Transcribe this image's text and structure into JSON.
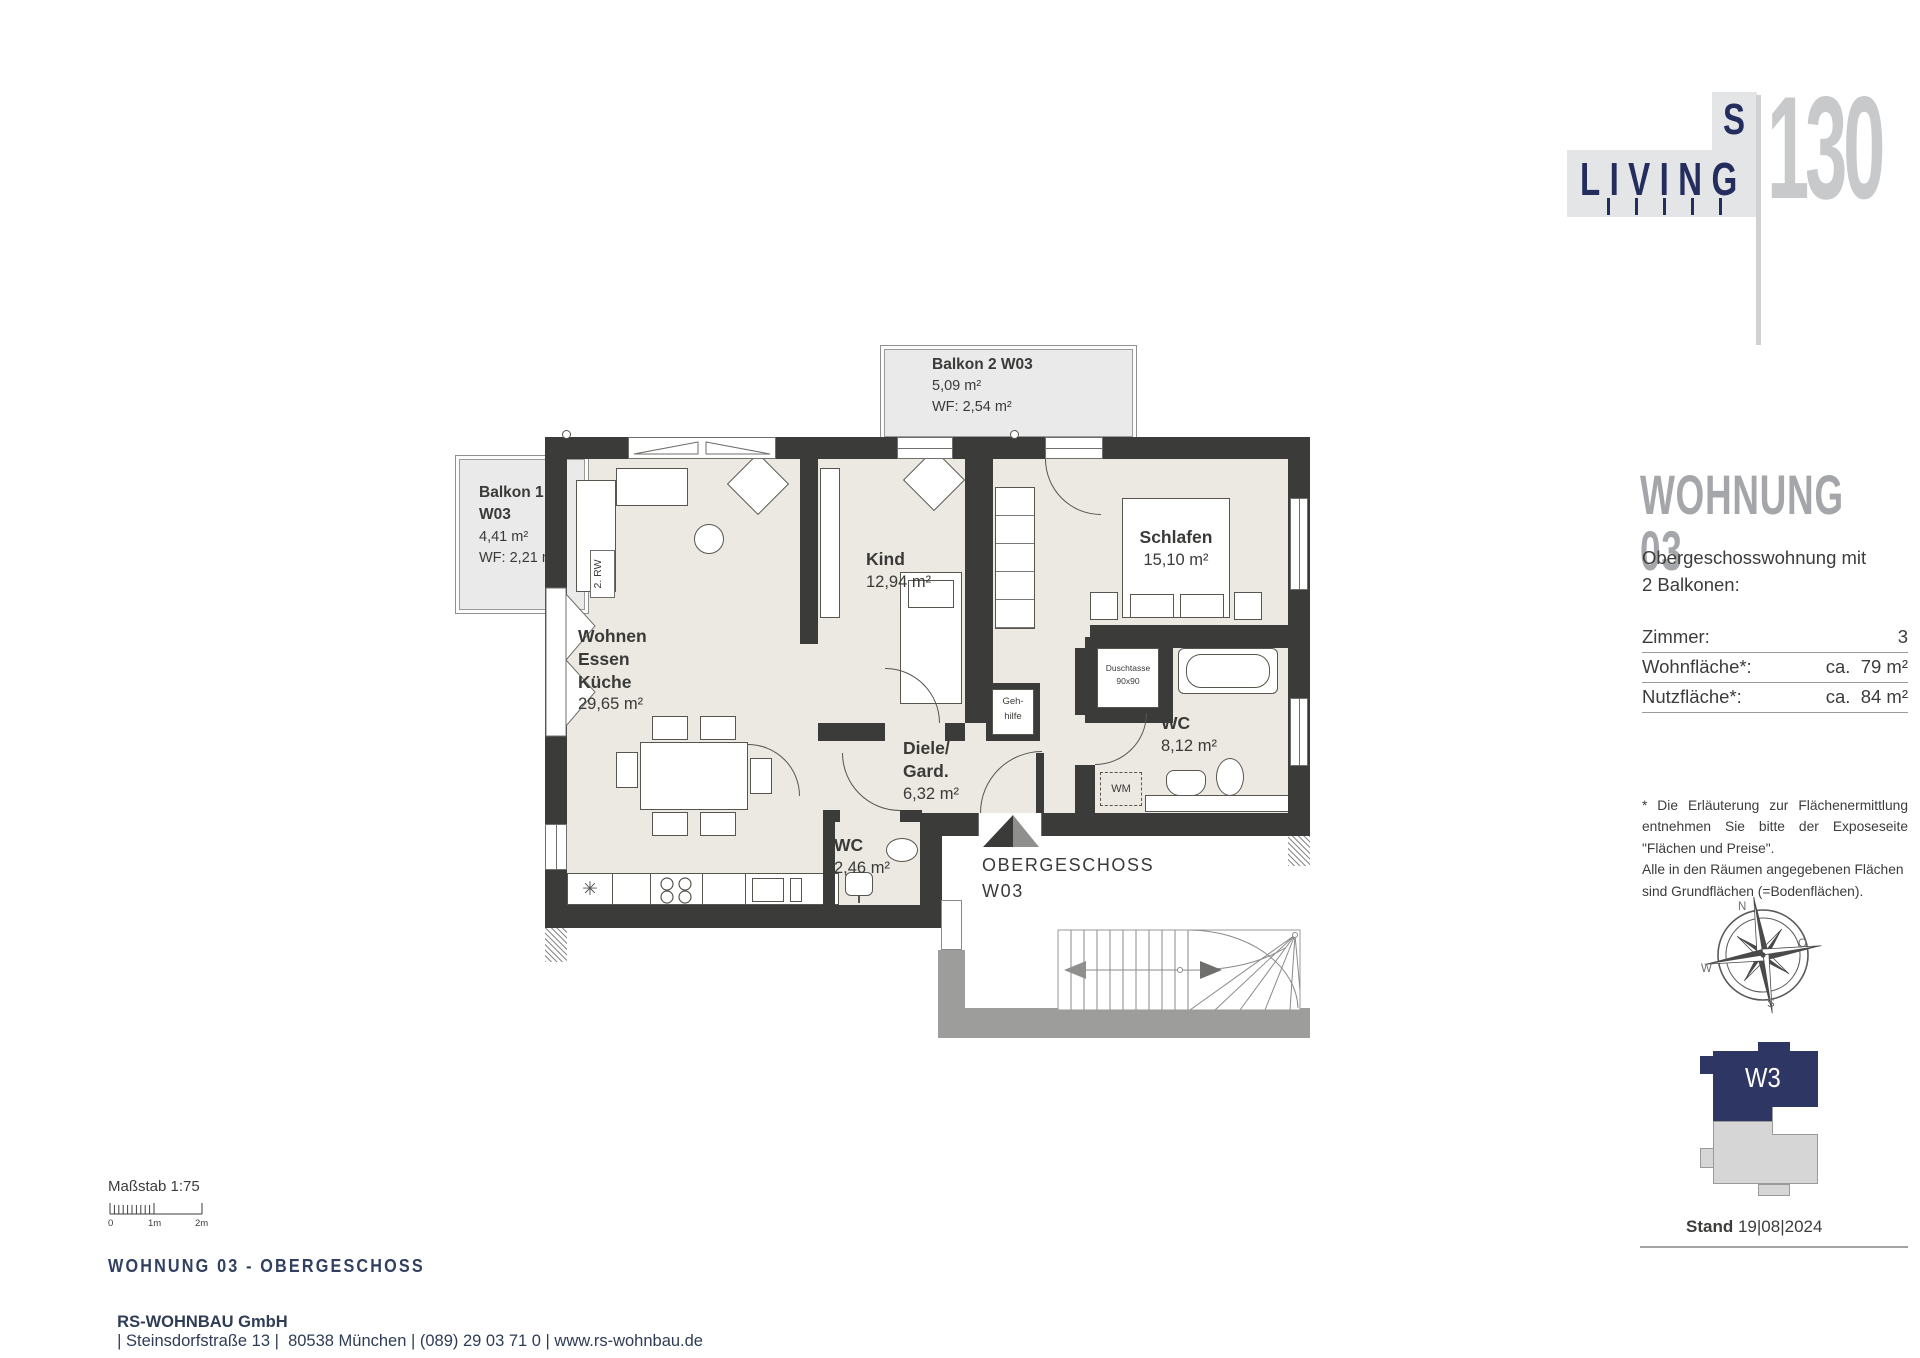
{
  "logo": {
    "brand": "LIVING",
    "letter_s": "S",
    "number": "130"
  },
  "panel": {
    "title": "WOHNUNG 03",
    "intro_line1": "Obergeschosswohnung mit",
    "intro_line2": "2 Balkonen:",
    "facts": [
      {
        "label": "Zimmer:",
        "value": "3"
      },
      {
        "label": "Wohnfläche*:",
        "value": "ca.  79 m²"
      },
      {
        "label": "Nutzfläche*:",
        "value": "ca.  84 m²"
      }
    ],
    "footnote_line1": "* Die Erläuterung zur Flächenermittlung entnehmen Sie bitte der Exposeseite \"Flächen und Preise\".",
    "footnote_line2": "Alle in den Räumen angegebenen Flächen sind Grundflächen (=Bodenflächen).",
    "compass": {
      "n": "N",
      "e": "O",
      "s": "S",
      "w": "W"
    },
    "building": {
      "unit": "W3"
    },
    "stand": {
      "label": "Stand",
      "date": "19|08|2024"
    }
  },
  "plan": {
    "balkon1": {
      "line1": "Balkon 1",
      "line2": "W03",
      "area": "4,41 m²",
      "wf": "WF: 2,21 m²"
    },
    "balkon2": {
      "name": "Balkon 2 W03",
      "area": "5,09 m²",
      "wf": "WF: 2,54 m²"
    },
    "rooms": {
      "wohnen": {
        "line1": "Wohnen",
        "line2": "Essen",
        "line3": "Küche",
        "area": "29,65 m²"
      },
      "kind": {
        "name": "Kind",
        "area": "12,94 m²"
      },
      "schlafen": {
        "name": "Schlafen",
        "area": "15,10 m²"
      },
      "diele": {
        "line1": "Diele/",
        "line2": "Gard.",
        "area": "6,32 m²"
      },
      "bad": {
        "name": "WC",
        "area": "8,12 m²"
      },
      "wc": {
        "name": "WC",
        "area": "2,46 m²"
      }
    },
    "annotations": {
      "rw": "2. RW",
      "gehhilfe_line1": "Geh-",
      "gehhilfe_line2": "hilfe",
      "dusche_line1": "Duschtasse",
      "dusche_line2": "90x90",
      "wm": "WM",
      "sink_icon": "✳"
    },
    "floor_label": {
      "line1": "OBERGESCHOSS",
      "line2": "W03"
    }
  },
  "footer": {
    "scale_caption": "Maßstab 1:75",
    "scale_ticks": [
      "0",
      "1m",
      "2m"
    ],
    "title": "WOHNUNG 03 - OBERGESCHOSS",
    "company": "RS-WOHNBAU GmbH",
    "details": "| Steinsdorfstraße 13 |  80538 München | (089) 29 03 71 0 | www.rs-wohnbau.de"
  }
}
